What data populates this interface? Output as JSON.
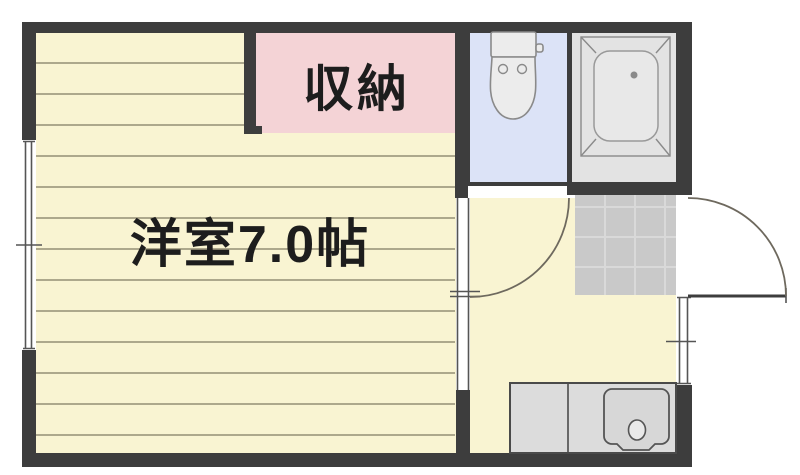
{
  "labels": {
    "room": "洋室7.0帖",
    "closet": "収納"
  },
  "rooms": [
    {
      "id": "western-room",
      "label": "洋室7.0帖",
      "floor": "wood-plank",
      "color": "#f9f4d2"
    },
    {
      "id": "closet",
      "label": "収納",
      "color": "#f4d3d6"
    },
    {
      "id": "toilet-room",
      "label": "",
      "color": "#dce3f7",
      "fixture": "toilet-icon"
    },
    {
      "id": "bathroom",
      "label": "",
      "color": "#e3e3e3",
      "fixture": "bathtub-icon"
    },
    {
      "id": "kitchen-hall",
      "label": "",
      "color": "#f9f4d2",
      "fixture": "kitchen-sink-icon"
    },
    {
      "id": "entrance-genkan",
      "label": "",
      "color": "#c9c9c9"
    }
  ],
  "icons": [
    "toilet-icon",
    "bathtub-icon",
    "kitchen-sink-icon",
    "door-swing-arc",
    "window-symbol"
  ],
  "colors": {
    "bg": "#ffffff",
    "wall": "#3d3d3d",
    "floor": "#f9f4d2",
    "plank": "#948e74",
    "closet": "#f4d3d6",
    "toilet": "#dce3f7",
    "bath": "#e3e3e3",
    "tile": "#c9c9c9",
    "tile_line": "#d9d9d9",
    "fixture": "#ececec",
    "fixture_line": "#8a8a8a",
    "counter": "#dcdcdc",
    "counter_line": "#4a4a4a",
    "sink": "#d7d7d7",
    "sink_line": "#555555",
    "door_line": "#6e695e",
    "frame_line": "#555555",
    "text": "#1d1d1d"
  }
}
